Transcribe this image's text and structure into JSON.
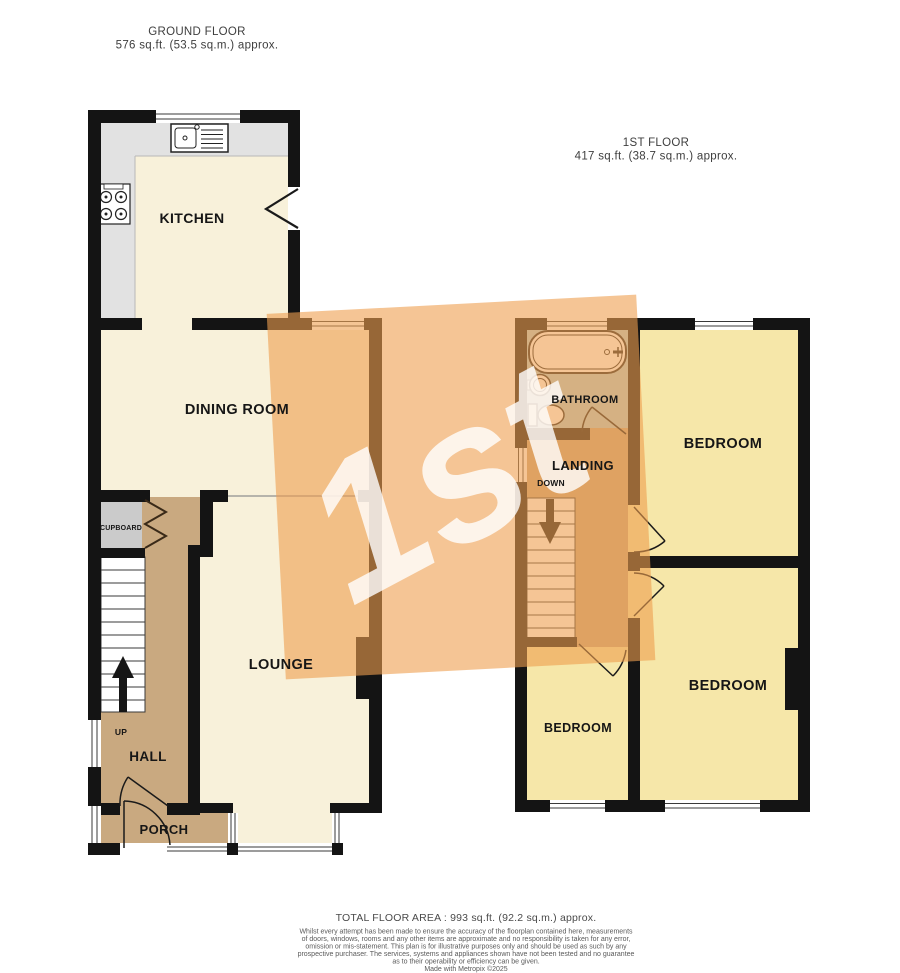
{
  "ground_floor": {
    "title": "GROUND FLOOR",
    "area": "576 sq.ft. (53.5 sq.m.) approx.",
    "kitchen": "KITCHEN",
    "dining_room": "DINING ROOM",
    "lounge": "LOUNGE",
    "hall": "HALL",
    "porch": "PORCH",
    "cupboard": "CUPBOARD",
    "stairs_direction": "UP"
  },
  "first_floor": {
    "title": "1ST FLOOR",
    "area": "417 sq.ft. (38.7 sq.m.) approx.",
    "bathroom": "BATHROOM",
    "landing": "LANDING",
    "stairs_direction": "DOWN",
    "bedroom_top": "BEDROOM",
    "bedroom_bottom_right": "BEDROOM",
    "bedroom_bottom_left": "BEDROOM"
  },
  "watermark": {
    "text": "1st"
  },
  "footer": {
    "total_area": "TOTAL FLOOR AREA : 993 sq.ft. (92.2 sq.m.) approx.",
    "disclaimer": [
      "Whilst every attempt has been made to ensure the accuracy of the floorplan contained here, measurements",
      "of doors, windows, rooms and any other items are approximate and no responsibility is taken for any error,",
      "omission or mis-statement. This plan is for illustrative purposes only and should be used as such by any",
      "prospective purchaser. The services, systems and appliances shown have not been tested and no guarantee",
      "as to their operability or efficiency can be given."
    ],
    "credit": "Made with Metropix ©2025"
  },
  "colors": {
    "wall": "#141414",
    "room_cream": "#F8F1DA",
    "room_yellow": "#F6E7A9",
    "hall_tan": "#C9A980",
    "cupboard_grey": "#CBCBCB",
    "worktop_grey": "#E2E2E2",
    "bathroom_blue": "#AECDD3",
    "watermark_orange": "#EE9F4F"
  }
}
